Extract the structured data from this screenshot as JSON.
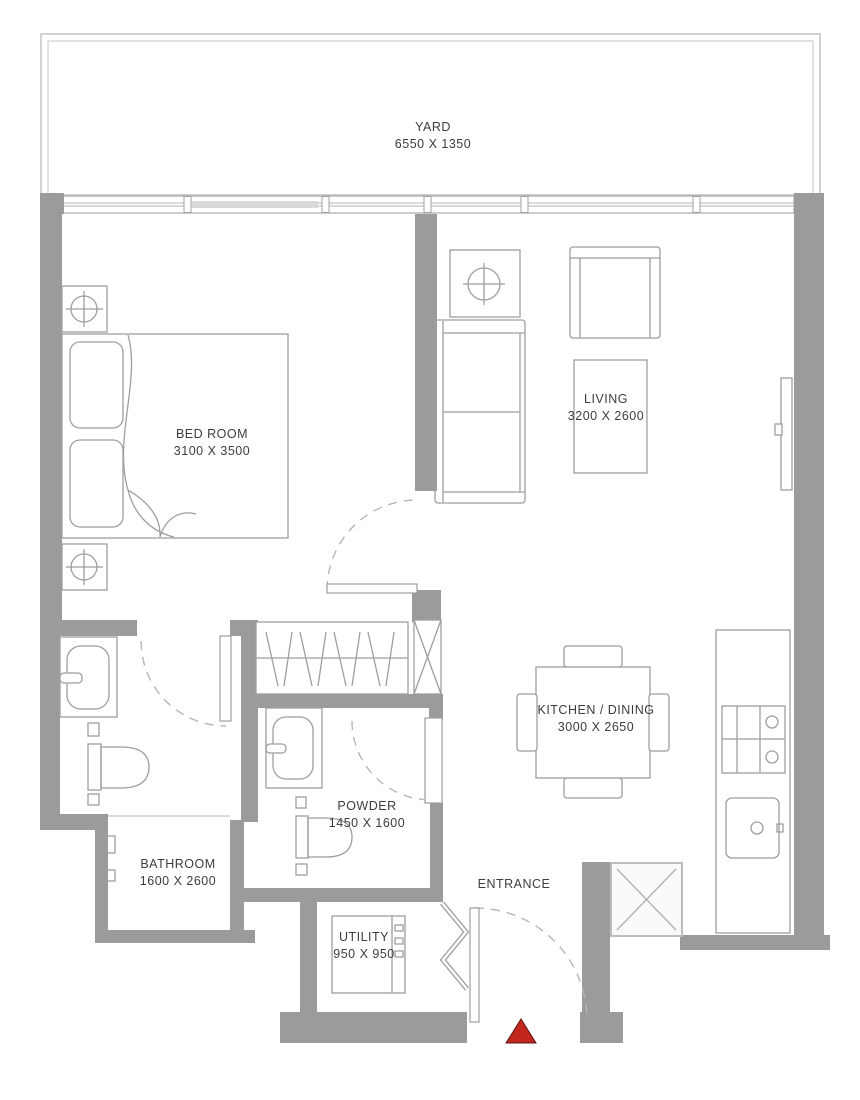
{
  "document": {
    "type": "apartment-floor-plan"
  },
  "rooms": [
    {
      "key": "yard",
      "name": "YARD",
      "dimensions": "6550 X 1350"
    },
    {
      "key": "bedroom",
      "name": "BED ROOM",
      "dimensions": "3100 X 3500"
    },
    {
      "key": "living",
      "name": "LIVING",
      "dimensions": "3200 X 2600"
    },
    {
      "key": "kitchen-dining",
      "name": "KITCHEN / DINING",
      "dimensions": "3000 X 2650"
    },
    {
      "key": "bathroom",
      "name": "BATHROOM",
      "dimensions": "1600 X 2600"
    },
    {
      "key": "powder",
      "name": "POWDER",
      "dimensions": "1450 X 1600"
    },
    {
      "key": "utility",
      "name": "UTILITY",
      "dimensions": "950 X 950"
    },
    {
      "key": "entrance",
      "name": "ENTRANCE",
      "dimensions": ""
    }
  ],
  "symbols": {
    "entrance_marker": "red-triangle"
  },
  "colors": {
    "wall": "#9b9b9b",
    "furniture_line": "#9e9e9e",
    "text": "#3d3d3d",
    "marker_red": "#c1271d",
    "yard_outline": "#c6c6c6",
    "window_glass": "#d9d9d9"
  }
}
